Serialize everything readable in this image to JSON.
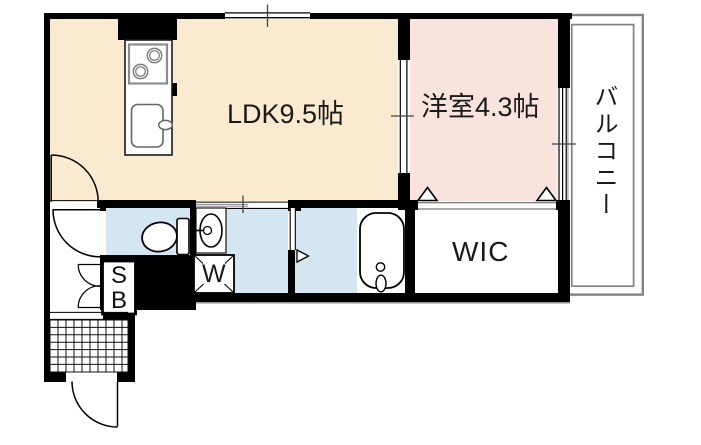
{
  "floorplan": {
    "rooms": {
      "ldk": {
        "label": "LDK9.5帖",
        "floor_color": "#faead0"
      },
      "bedroom": {
        "label": "洋室4.3帖",
        "floor_color": "#f8e4dc"
      },
      "balcony": {
        "label": "バルコニー"
      },
      "wic": {
        "label": "WIC"
      },
      "toilet": {
        "floor_color": "#d4e6f2"
      },
      "washroom": {
        "floor_color": "#d4e6f2"
      },
      "bathroom": {
        "floor_color": "#d4e6f2"
      }
    },
    "fixtures": {
      "washer_pan_label": "W",
      "shoe_box": {
        "line1": "S",
        "line2": "B"
      }
    },
    "colors": {
      "wall": "#000000",
      "balcony_line": "#828282",
      "tick": "#444444",
      "under_wall_shadow": "#8a8a8a"
    }
  }
}
